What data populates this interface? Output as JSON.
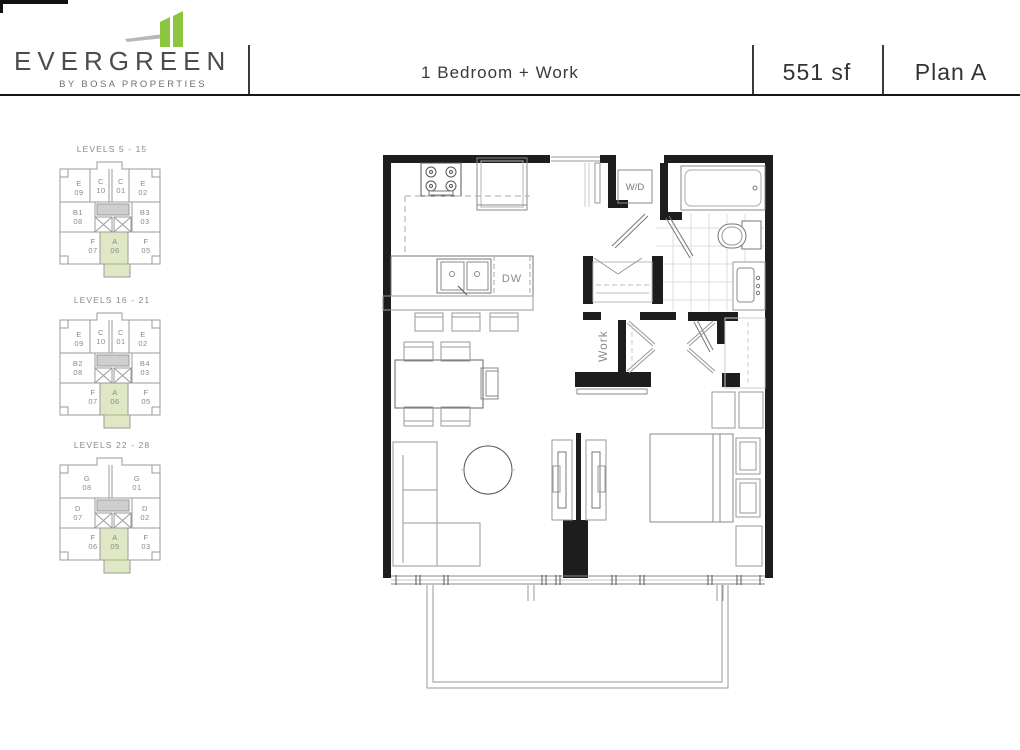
{
  "header": {
    "brand": {
      "name": "EVERGREEN",
      "tagline": "BY BOSA PROPERTIES"
    },
    "plan_type": "1 Bedroom + Work",
    "area": "551 sf",
    "plan_name": "Plan A"
  },
  "colors": {
    "brand_green": "#8cc63f",
    "keyplan_highlight": "#dfe7c4",
    "wall": "#1d1d1d"
  },
  "keyplans": [
    {
      "title": "LEVELS 5 - 15",
      "units": {
        "top": [
          {
            "letter": "E",
            "num": "09"
          },
          {
            "letter": "C",
            "num": "10"
          },
          {
            "letter": "C",
            "num": "01"
          },
          {
            "letter": "E",
            "num": "02"
          }
        ],
        "mid": [
          {
            "letter": "B1",
            "num": "08"
          },
          {
            "letter": "B3",
            "num": "03"
          }
        ],
        "bottom": [
          {
            "letter": "F",
            "num": "07"
          },
          {
            "letter": "A",
            "num": "06",
            "highlighted": true
          },
          {
            "letter": "F",
            "num": "05"
          }
        ]
      }
    },
    {
      "title": "LEVELS 16 - 21",
      "units": {
        "top": [
          {
            "letter": "E",
            "num": "09"
          },
          {
            "letter": "C",
            "num": "10"
          },
          {
            "letter": "C",
            "num": "01"
          },
          {
            "letter": "E",
            "num": "02"
          }
        ],
        "mid": [
          {
            "letter": "B2",
            "num": "08"
          },
          {
            "letter": "B4",
            "num": "03"
          }
        ],
        "bottom": [
          {
            "letter": "F",
            "num": "07"
          },
          {
            "letter": "A",
            "num": "06",
            "highlighted": true
          },
          {
            "letter": "F",
            "num": "05"
          }
        ]
      }
    },
    {
      "title": "LEVELS 22 - 28",
      "units": {
        "top": [
          {
            "letter": "G",
            "num": "08"
          },
          {
            "letter": "G",
            "num": "01"
          }
        ],
        "mid": [
          {
            "letter": "D",
            "num": "07"
          },
          {
            "letter": "D",
            "num": "02"
          }
        ],
        "bottom": [
          {
            "letter": "F",
            "num": "06"
          },
          {
            "letter": "A",
            "num": "05",
            "highlighted": true
          },
          {
            "letter": "F",
            "num": "03"
          }
        ]
      }
    }
  ],
  "floorplan": {
    "labels": {
      "washer_dryer": "W/D",
      "dishwasher": "DW",
      "work": "Work"
    }
  }
}
